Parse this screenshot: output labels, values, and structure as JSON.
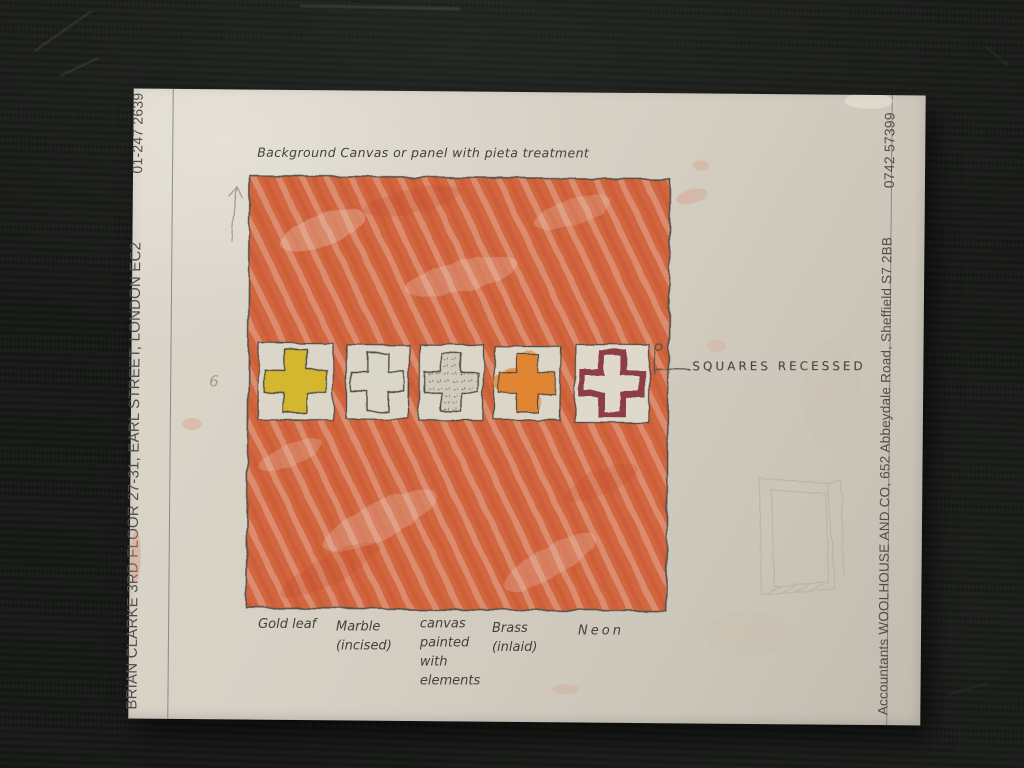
{
  "letterhead": {
    "phone_left": "01-247 2639",
    "address_left": "BRIAN CLARKE  3RD FLOOR 27-31, EARL STREET, LONDON EC2",
    "phone_right": "0742 57399",
    "address_right": "Accountants WOOLHOUSE AND CO, 652 Abbeydale Road, Sheffield S7 2BB"
  },
  "sketch": {
    "title": "Background Canvas or panel with pieta treatment",
    "annotation": "SQUARES RECESSED",
    "pencil_mark": "6",
    "labels": [
      "Gold leaf",
      "Marble\n(incised)",
      "canvas\npainted\nwith\nelements",
      "Brass\n(inlaid)",
      "Neon"
    ],
    "colors": {
      "background_red": "#d2663f",
      "gold_leaf": "#d4b72e",
      "marble": "#dad6c8",
      "canvas": "#cfcaba",
      "brass": "#e08530",
      "neon": "#8e3c44",
      "pencil": "#4d4b43"
    }
  }
}
